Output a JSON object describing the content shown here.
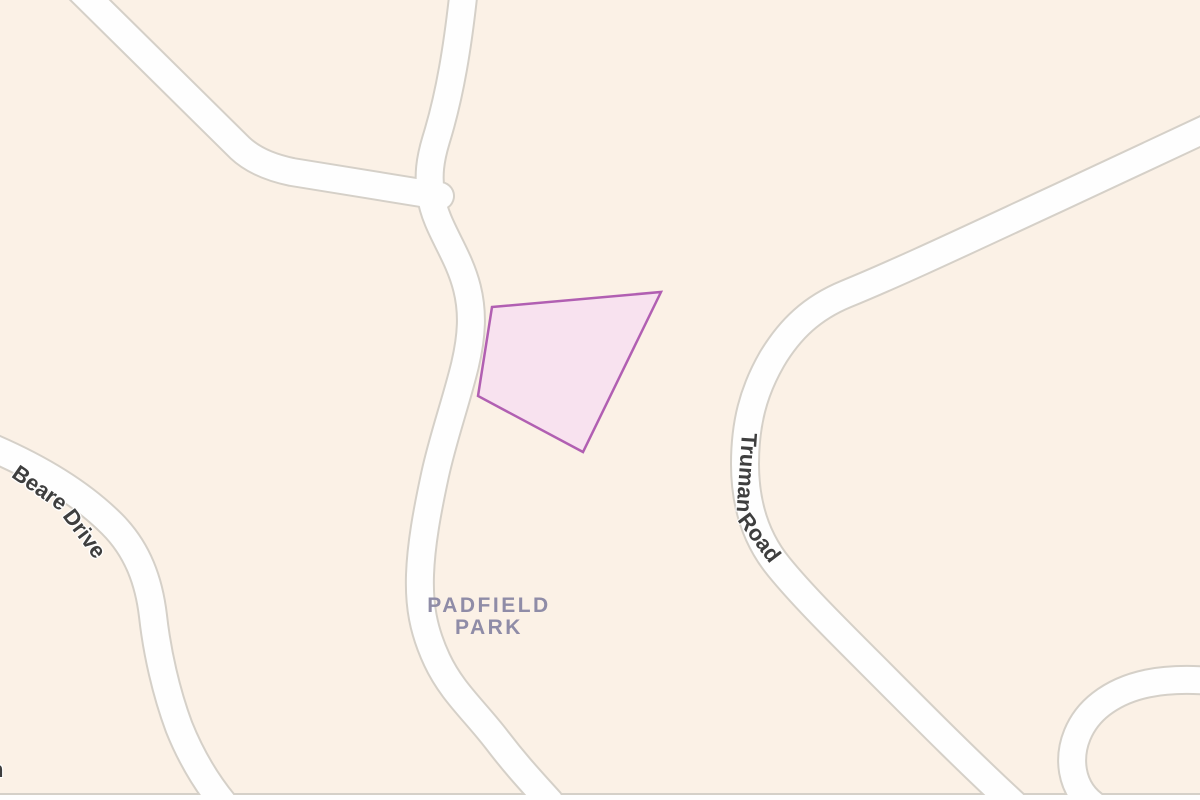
{
  "map": {
    "kind": "parcel-map-view",
    "colors": {
      "background": "#fbf1e6",
      "road_fill": "#fefefe",
      "road_casing": "#d5d0c8",
      "parcel_fill": "#f8e2ef",
      "parcel_stroke": "#b15fb2",
      "park_label": "#8f8ca7",
      "road_label": "#3e3e3e"
    },
    "parcel": {
      "description": "highlighted lot polygon"
    },
    "labels": {
      "park": {
        "lines": [
          "PADFIELD",
          "PARK"
        ]
      },
      "beare_drive": {
        "words": [
          "Beare",
          "Drive"
        ]
      },
      "truman_road": {
        "words": [
          "Truman",
          "Road"
        ]
      },
      "edge_fragment": "n"
    }
  }
}
